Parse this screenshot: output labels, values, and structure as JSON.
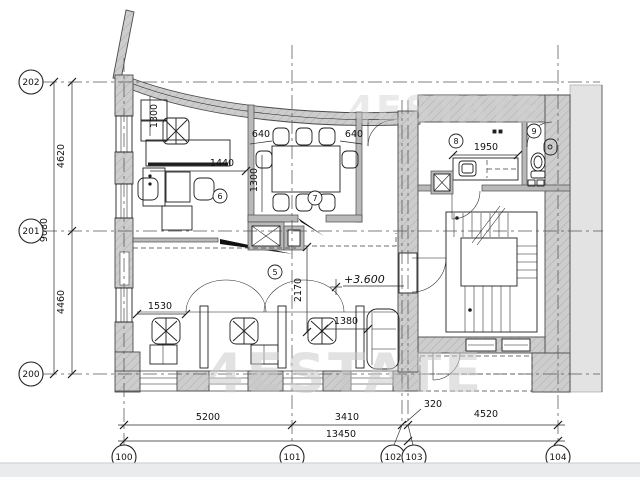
{
  "plan": {
    "watermark": "4ESTATE",
    "elevation": "+3.600",
    "rooms": {
      "open_office": "5",
      "office": "6",
      "meeting": "7",
      "kitchen": "8",
      "wc": "9"
    },
    "grid": {
      "rows": [
        {
          "label": "202"
        },
        {
          "label": "201"
        },
        {
          "label": "200"
        }
      ],
      "cols": [
        {
          "label": "100"
        },
        {
          "label": "101"
        },
        {
          "label": "102"
        },
        {
          "label": "103"
        },
        {
          "label": "104"
        }
      ]
    },
    "dimensions": {
      "left_upper": "4620",
      "left_lower": "4460",
      "left_total": "9080",
      "bottom_a": "5200",
      "bottom_b": "3410",
      "bottom_c": "320",
      "bottom_d": "4520",
      "bottom_total": "13450",
      "office_depth": "1300",
      "office_width": "1440",
      "meeting_left": "640",
      "meeting_right": "640",
      "meeting_depth": "1300",
      "kitchen_width": "1950",
      "open_depth": "2170",
      "sofa_width": "1380",
      "desk_width": "1530"
    }
  }
}
